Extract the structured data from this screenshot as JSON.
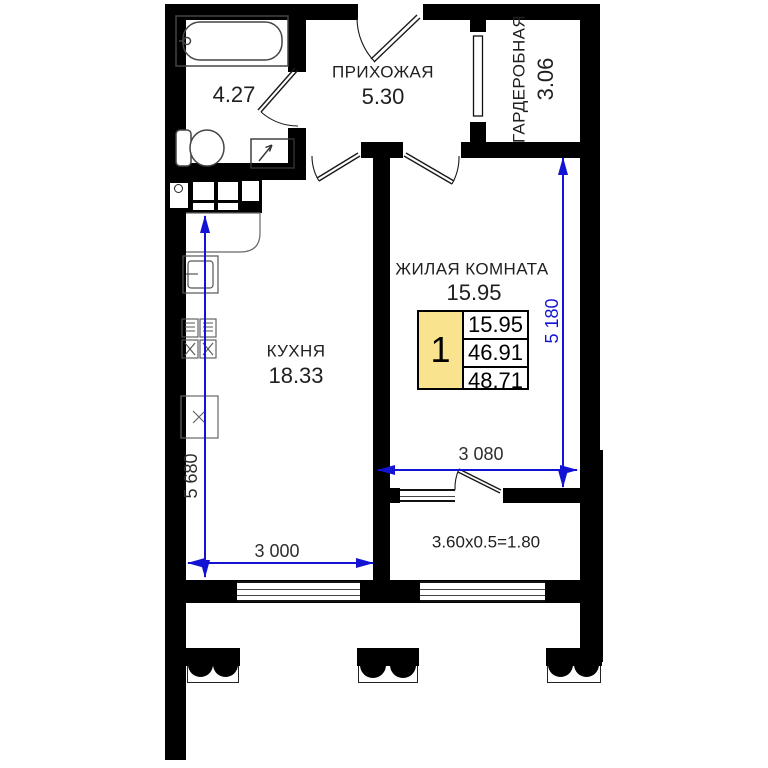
{
  "rooms": {
    "hallway": {
      "name": "ПРИХОЖАЯ",
      "area": "5.30"
    },
    "bathroom": {
      "area": "4.27"
    },
    "wardrobe": {
      "name": "ГАРДЕРОБНАЯ",
      "area": "3.06"
    },
    "kitchen": {
      "name": "КУХНЯ",
      "area": "18.33"
    },
    "living_room": {
      "name": "ЖИЛАЯ КОМНАТА",
      "area": "15.95"
    },
    "loggia": {
      "area_formula": "3.60x0.5=1.80"
    }
  },
  "info_table": {
    "rooms_count": "1",
    "rows": [
      "15.95",
      "46.91",
      "48.71"
    ]
  },
  "dimensions": {
    "kitchen_depth": "5 680",
    "kitchen_width": "3 000",
    "living_depth": "5 180",
    "living_width": "3 080"
  },
  "colors": {
    "wall": "#000000",
    "dimension_blue": "#1313d4",
    "table_yellow": "#fae38e"
  }
}
